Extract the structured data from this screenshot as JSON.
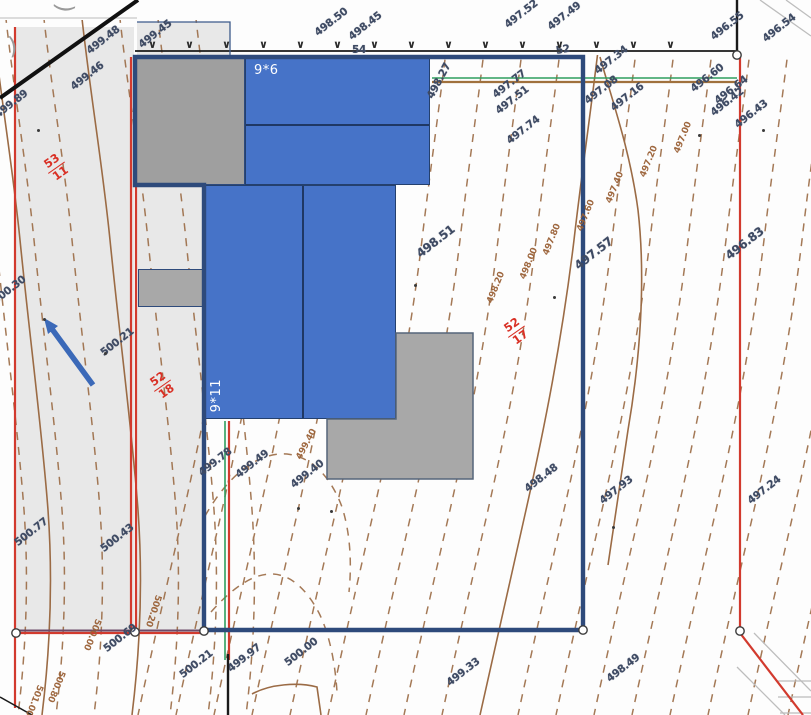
{
  "drawing": {
    "building_labels": {
      "top": "9*6",
      "main": "9*11"
    },
    "fence": {
      "glyph": "∨",
      "count": 15
    },
    "corner_fragments": [
      ")",
      ")"
    ],
    "spot_elevations": [
      {
        "t": "499.48",
        "x": 88,
        "y": 46,
        "r": -38
      },
      {
        "t": "499.46",
        "x": 72,
        "y": 82,
        "r": -38
      },
      {
        "t": "499.45",
        "x": 140,
        "y": 40,
        "r": -38
      },
      {
        "t": "499.89",
        "x": -4,
        "y": 110,
        "r": -38
      },
      {
        "t": "498.50",
        "x": 316,
        "y": 28,
        "r": -38
      },
      {
        "t": "498.45",
        "x": 350,
        "y": 32,
        "r": -38
      },
      {
        "t": "54",
        "x": 352,
        "y": 44,
        "r": 0
      },
      {
        "t": "497.52",
        "x": 506,
        "y": 20,
        "r": -38
      },
      {
        "t": "497.49",
        "x": 549,
        "y": 22,
        "r": -38
      },
      {
        "t": "52",
        "x": 556,
        "y": 45,
        "r": -10
      },
      {
        "t": "496.55",
        "x": 712,
        "y": 32,
        "r": -38
      },
      {
        "t": "496.54",
        "x": 764,
        "y": 34,
        "r": -38
      },
      {
        "t": "497.34",
        "x": 596,
        "y": 66,
        "r": -38
      },
      {
        "t": "497.08",
        "x": 586,
        "y": 96,
        "r": -38
      },
      {
        "t": "497.16",
        "x": 612,
        "y": 103,
        "r": -38
      },
      {
        "t": "497.77",
        "x": 494,
        "y": 90,
        "r": -38
      },
      {
        "t": "497.51",
        "x": 497,
        "y": 106,
        "r": -38
      },
      {
        "t": "497.74",
        "x": 508,
        "y": 136,
        "r": -38
      },
      {
        "t": "498.27",
        "x": 430,
        "y": 92,
        "r": -62
      },
      {
        "t": "496.60",
        "x": 692,
        "y": 84,
        "r": -38
      },
      {
        "t": "496.64",
        "x": 716,
        "y": 96,
        "r": -38
      },
      {
        "t": "496.42",
        "x": 712,
        "y": 108,
        "r": -38
      },
      {
        "t": "496.43",
        "x": 736,
        "y": 120,
        "r": -38
      },
      {
        "t": "497.57",
        "x": 576,
        "y": 260,
        "r": -38,
        "big": true
      },
      {
        "t": "496.83",
        "x": 727,
        "y": 250,
        "r": -38,
        "big": true
      },
      {
        "t": "498.51",
        "x": 418,
        "y": 248,
        "r": -38,
        "big": true
      },
      {
        "t": "499.78",
        "x": 200,
        "y": 468,
        "r": -38
      },
      {
        "t": "499.49",
        "x": 237,
        "y": 470,
        "r": -38
      },
      {
        "t": "499.40",
        "x": 292,
        "y": 480,
        "r": -38
      },
      {
        "t": "498.48",
        "x": 526,
        "y": 484,
        "r": -38
      },
      {
        "t": "497.93",
        "x": 601,
        "y": 496,
        "r": -38
      },
      {
        "t": "497.24",
        "x": 749,
        "y": 496,
        "r": -38
      },
      {
        "t": "499.33",
        "x": 448,
        "y": 678,
        "r": -38
      },
      {
        "t": "498.49",
        "x": 608,
        "y": 674,
        "r": -38
      },
      {
        "t": "500.00",
        "x": 286,
        "y": 658,
        "r": -38
      },
      {
        "t": "499.97",
        "x": 229,
        "y": 664,
        "r": -38
      },
      {
        "t": "500.21",
        "x": 181,
        "y": 670,
        "r": -38
      },
      {
        "t": "500.69",
        "x": 105,
        "y": 644,
        "r": -38
      },
      {
        "t": "500.77",
        "x": 16,
        "y": 538,
        "r": -38
      },
      {
        "t": "500.43",
        "x": 102,
        "y": 544,
        "r": -38
      },
      {
        "t": "500.30",
        "x": -6,
        "y": 296,
        "r": -38
      },
      {
        "t": "500.21",
        "x": 102,
        "y": 348,
        "r": -38
      }
    ],
    "contour_labels": [
      {
        "t": "498.20",
        "x": 490,
        "y": 298,
        "r": -68
      },
      {
        "t": "498.00",
        "x": 523,
        "y": 274,
        "r": -68
      },
      {
        "t": "497.80",
        "x": 546,
        "y": 250,
        "r": -68
      },
      {
        "t": "497.60",
        "x": 580,
        "y": 226,
        "r": -68
      },
      {
        "t": "497.40",
        "x": 609,
        "y": 198,
        "r": -68
      },
      {
        "t": "497.20",
        "x": 643,
        "y": 172,
        "r": -68
      },
      {
        "t": "497.00",
        "x": 677,
        "y": 148,
        "r": -68
      },
      {
        "t": "499.40",
        "x": 299,
        "y": 454,
        "r": -62
      },
      {
        "t": "500.80",
        "x": 62,
        "y": 666,
        "r": 112
      },
      {
        "t": "501.00",
        "x": 40,
        "y": 680,
        "r": 112
      },
      {
        "t": "500.20",
        "x": 158,
        "y": 590,
        "r": 108
      },
      {
        "t": "500.00",
        "x": 98,
        "y": 614,
        "r": 112
      }
    ],
    "slope_ratios": [
      {
        "num": "53",
        "den": "11",
        "x": 48,
        "y": 160,
        "r": -35
      },
      {
        "num": "52",
        "den": "18",
        "x": 154,
        "y": 378,
        "r": -35
      },
      {
        "num": "52",
        "den": "17",
        "x": 508,
        "y": 324,
        "r": -35
      }
    ],
    "dots": [
      [
        37,
        129
      ],
      [
        43,
        318
      ],
      [
        104,
        352
      ],
      [
        330,
        510
      ],
      [
        414,
        284
      ],
      [
        612,
        526
      ],
      [
        553,
        296
      ],
      [
        698,
        134
      ],
      [
        297,
        507
      ],
      [
        762,
        129
      ]
    ],
    "colors": {
      "building_blue": "#4673c8",
      "boundary_navy": "#2e4a7b",
      "parcel_red": "#d23a2e",
      "contour_brown": "#9b6b45",
      "parcel_gray": "#e8e8e8"
    }
  }
}
